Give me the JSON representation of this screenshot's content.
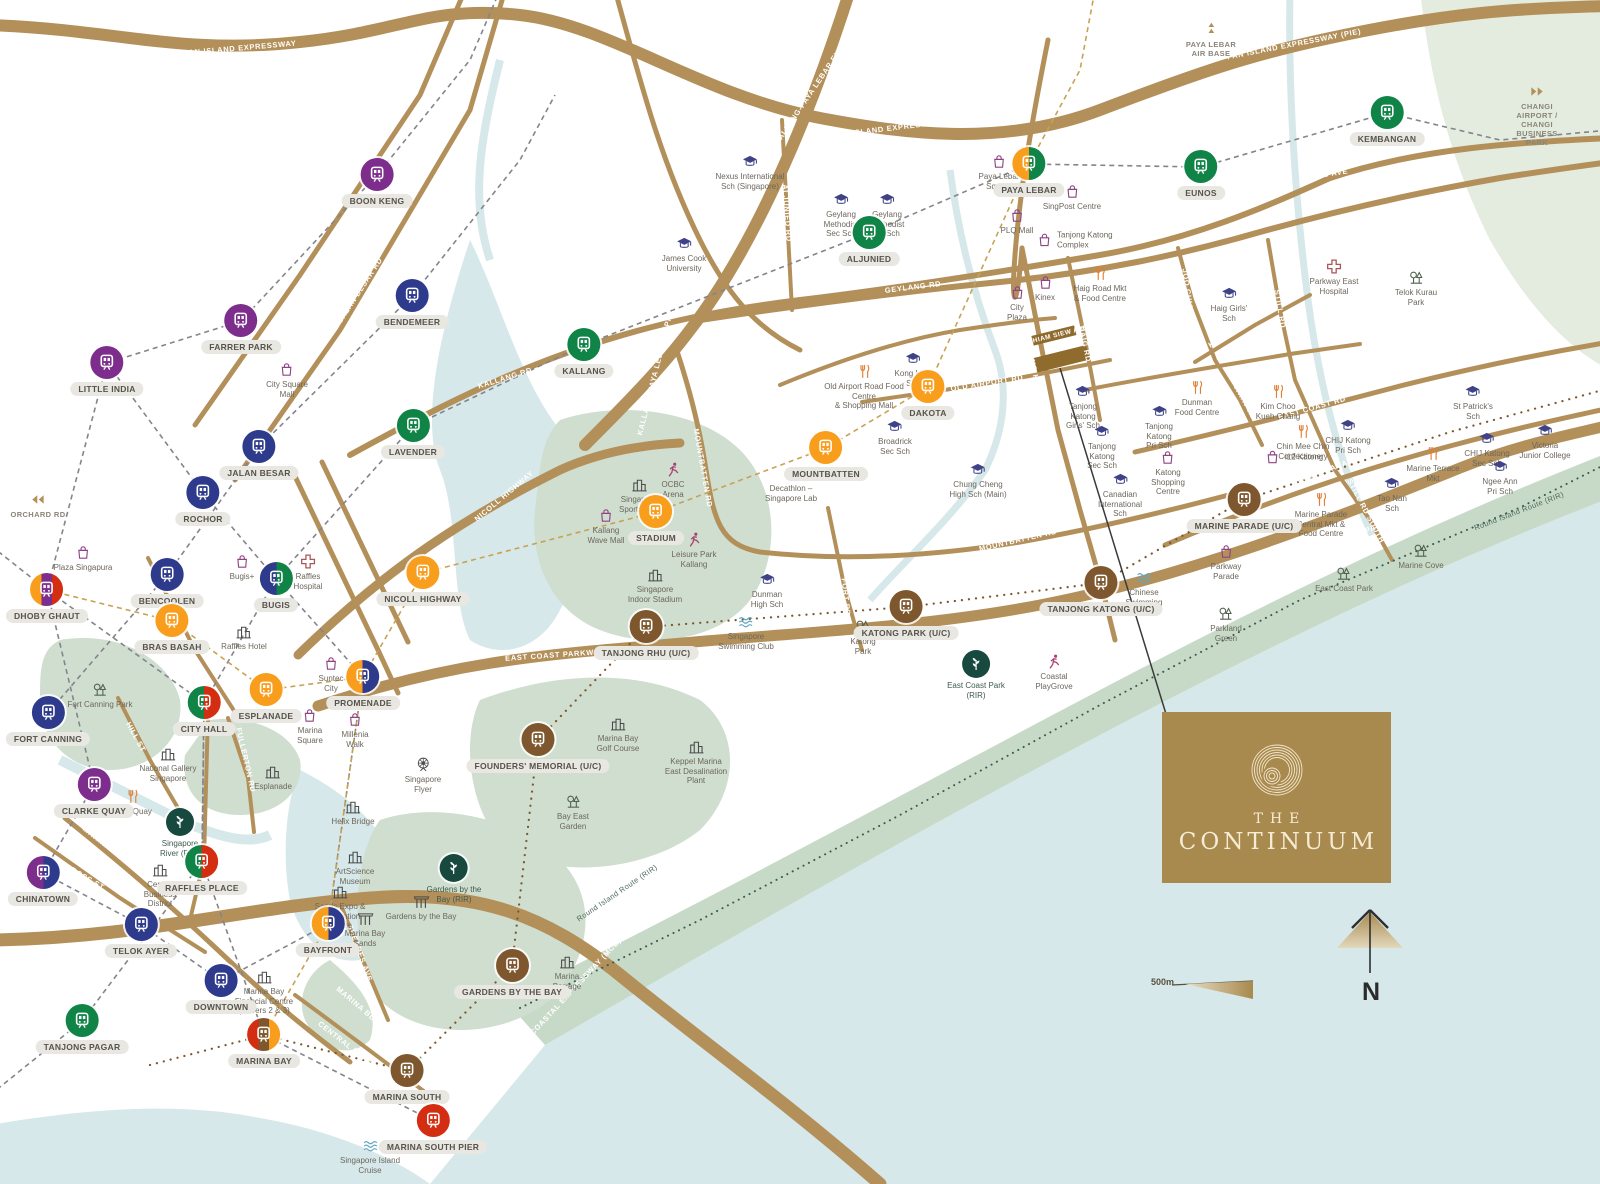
{
  "branding": {
    "line1": "THE",
    "line2": "CONTINUUM"
  },
  "map": {
    "scale": {
      "label": "500m"
    },
    "compass": {
      "label": "N"
    },
    "site": {
      "label": "THIAM SIEW AVE"
    },
    "colors": {
      "ne": "#7d2e8d",
      "dt": "#2e3a8c",
      "ew": "#108347",
      "cc": "#f99d1c",
      "ns": "#d42e12",
      "te": "#7e572e",
      "rir": "#17493f",
      "road": "#b3905a",
      "sea": "#d6e8ea",
      "park": "#cfdecf",
      "brand": "#a8894e"
    },
    "stations": [
      {
        "n": "BOON KENG",
        "x": 377,
        "y": 175,
        "c": [
          "ne"
        ]
      },
      {
        "n": "BENDEMEER",
        "x": 412,
        "y": 296,
        "c": [
          "dt"
        ]
      },
      {
        "n": "FARRER PARK",
        "x": 241,
        "y": 321,
        "c": [
          "ne"
        ]
      },
      {
        "n": "LITTLE INDIA",
        "x": 107,
        "y": 363,
        "c": [
          "ne"
        ]
      },
      {
        "n": "JALAN BESAR",
        "x": 259,
        "y": 447,
        "c": [
          "dt"
        ]
      },
      {
        "n": "ROCHOR",
        "x": 203,
        "y": 493,
        "c": [
          "dt"
        ]
      },
      {
        "n": "LAVENDER",
        "x": 413,
        "y": 426,
        "c": [
          "ew"
        ]
      },
      {
        "n": "KALLANG",
        "x": 584,
        "y": 345,
        "c": [
          "ew"
        ]
      },
      {
        "n": "BENCOOLEN",
        "x": 167,
        "y": 575,
        "c": [
          "dt"
        ]
      },
      {
        "n": "DHOBY GHAUT",
        "x": 47,
        "y": 590,
        "c": [
          "cc",
          "ne",
          "ns"
        ]
      },
      {
        "n": "BUGIS",
        "x": 276,
        "y": 579,
        "c": [
          "dt",
          "ew"
        ]
      },
      {
        "n": "BRAS BASAH",
        "x": 172,
        "y": 621,
        "c": [
          "cc"
        ]
      },
      {
        "n": "NICOLL HIGHWAY",
        "x": 423,
        "y": 573,
        "c": [
          "cc"
        ]
      },
      {
        "n": "ESPLANADE",
        "x": 266,
        "y": 690,
        "c": [
          "cc"
        ]
      },
      {
        "n": "PROMENADE",
        "x": 363,
        "y": 677,
        "c": [
          "cc",
          "dt"
        ]
      },
      {
        "n": "CITY HALL",
        "x": 204,
        "y": 703,
        "c": [
          "ew",
          "ns"
        ]
      },
      {
        "n": "FORT CANNING",
        "x": 48,
        "y": 713,
        "c": [
          "dt"
        ]
      },
      {
        "n": "CLARKE QUAY",
        "x": 94,
        "y": 785,
        "c": [
          "ne"
        ]
      },
      {
        "n": "RAFFLES PLACE",
        "x": 202,
        "y": 862,
        "c": [
          "ew",
          "ns"
        ]
      },
      {
        "n": "CHINATOWN",
        "x": 43,
        "y": 873,
        "c": [
          "ne",
          "dt"
        ]
      },
      {
        "n": "TELOK AYER",
        "x": 141,
        "y": 925,
        "c": [
          "dt"
        ]
      },
      {
        "n": "DOWNTOWN",
        "x": 221,
        "y": 981,
        "c": [
          "dt"
        ]
      },
      {
        "n": "TANJONG PAGAR",
        "x": 82,
        "y": 1021,
        "c": [
          "ew"
        ]
      },
      {
        "n": "MARINA BAY",
        "x": 264,
        "y": 1035,
        "c": [
          "ns",
          "te",
          "cc"
        ]
      },
      {
        "n": "MARINA SOUTH",
        "x": 407,
        "y": 1071,
        "c": [
          "te"
        ]
      },
      {
        "n": "MARINA SOUTH PIER",
        "x": 433,
        "y": 1121,
        "c": [
          "ns"
        ]
      },
      {
        "n": "GARDENS BY THE BAY",
        "x": 512,
        "y": 966,
        "c": [
          "te"
        ]
      },
      {
        "n": "FOUNDERS' MEMORIAL (U/C)",
        "x": 538,
        "y": 740,
        "c": [
          "te"
        ]
      },
      {
        "n": "TANJONG RHU (U/C)",
        "x": 646,
        "y": 627,
        "c": [
          "te"
        ]
      },
      {
        "n": "KATONG PARK (U/C)",
        "x": 906,
        "y": 607,
        "c": [
          "te"
        ]
      },
      {
        "n": "TANJONG KATONG (U/C)",
        "x": 1101,
        "y": 583,
        "c": [
          "te"
        ]
      },
      {
        "n": "MARINE PARADE (U/C)",
        "x": 1244,
        "y": 500,
        "c": [
          "te"
        ]
      },
      {
        "n": "STADIUM",
        "x": 656,
        "y": 512,
        "c": [
          "cc"
        ]
      },
      {
        "n": "MOUNTBATTEN",
        "x": 826,
        "y": 448,
        "c": [
          "cc"
        ]
      },
      {
        "n": "DAKOTA",
        "x": 928,
        "y": 387,
        "c": [
          "cc"
        ]
      },
      {
        "n": "ALJUNIED",
        "x": 869,
        "y": 233,
        "c": [
          "ew"
        ]
      },
      {
        "n": "PAYA LEBAR",
        "x": 1029,
        "y": 164,
        "c": [
          "cc",
          "ew"
        ]
      },
      {
        "n": "EUNOS",
        "x": 1201,
        "y": 167,
        "c": [
          "ew"
        ]
      },
      {
        "n": "KEMBANGAN",
        "x": 1387,
        "y": 113,
        "c": [
          "ew"
        ]
      },
      {
        "n": "BAYFRONT",
        "x": 328,
        "y": 924,
        "c": [
          "cc",
          "dt"
        ]
      }
    ],
    "rir_points": [
      {
        "n": "Singapore\nRiver (RIR)",
        "x": 180,
        "y": 822
      },
      {
        "n": "Gardens by the\nBay (RIR)",
        "x": 454,
        "y": 868
      },
      {
        "n": "East Coast Park\n(RIR)",
        "x": 976,
        "y": 664
      }
    ],
    "landmarks": [
      {
        "n": "City Square\nMall",
        "i": "bag",
        "x": 287,
        "y": 370
      },
      {
        "n": "Plaza Singapura",
        "i": "bag",
        "x": 83,
        "y": 553
      },
      {
        "n": "Bugis+",
        "i": "bag",
        "x": 242,
        "y": 562
      },
      {
        "n": "Suntec\nCity",
        "i": "bag",
        "x": 331,
        "y": 664
      },
      {
        "n": "Marina\nSquare",
        "i": "bag",
        "x": 310,
        "y": 716
      },
      {
        "n": "Millenia\nWalk",
        "i": "bag",
        "x": 355,
        "y": 720
      },
      {
        "n": "Kallang\nWave Mall",
        "i": "bag",
        "x": 606,
        "y": 516
      },
      {
        "n": "Paya Lebar\nSquare",
        "i": "bag",
        "x": 999,
        "y": 162
      },
      {
        "n": "SingPost Centre",
        "i": "bag",
        "x": 1072,
        "y": 192
      },
      {
        "n": "PLQ Mall",
        "i": "bag",
        "x": 1017,
        "y": 216
      },
      {
        "n": "Tanjong Katong\nComplex",
        "i": "bag",
        "x": 1045,
        "y": 240,
        "lp": "r"
      },
      {
        "n": "Kinex",
        "i": "bag",
        "x": 1045,
        "y": 283
      },
      {
        "n": "City\nPlaza",
        "i": "bag",
        "x": 1017,
        "y": 293
      },
      {
        "n": "Katong\nShopping\nCentre",
        "i": "bag",
        "x": 1168,
        "y": 458
      },
      {
        "n": "i12 Katong",
        "i": "bag",
        "x": 1273,
        "y": 457,
        "lp": "r"
      },
      {
        "n": "Parkway\nParade",
        "i": "bag",
        "x": 1226,
        "y": 552
      },
      {
        "n": "Decathlon –\nSingapore Lab",
        "i": "bag",
        "x": 791,
        "y": 474
      },
      {
        "n": "Old Airport Road Food Centre\n& Shopping Mall",
        "i": "food",
        "x": 864,
        "y": 372
      },
      {
        "n": "Haig Road Mkt\n& Food Centre",
        "i": "food",
        "x": 1100,
        "y": 274
      },
      {
        "n": "Dunman\nFood Centre",
        "i": "food",
        "x": 1197,
        "y": 388
      },
      {
        "n": "Kim Choo\nKueh Chang",
        "i": "food",
        "x": 1278,
        "y": 392
      },
      {
        "n": "Chin Mee Chin\nConfectionery",
        "i": "food",
        "x": 1303,
        "y": 432
      },
      {
        "n": "Marine Parade\nCentral Mkt &\nFood Centre",
        "i": "food",
        "x": 1321,
        "y": 500
      },
      {
        "n": "Marine Terrace\nMkt",
        "i": "food",
        "x": 1433,
        "y": 454
      },
      {
        "n": "Boat Quay",
        "i": "food",
        "x": 133,
        "y": 797
      },
      {
        "n": "Nexus International\nSch (Singapore)",
        "i": "school",
        "x": 750,
        "y": 162
      },
      {
        "n": "James Cook\nUniversity",
        "i": "school",
        "x": 684,
        "y": 244
      },
      {
        "n": "Geylang\nMethodist\nSec Sch",
        "i": "school",
        "x": 841,
        "y": 200
      },
      {
        "n": "Geylang\nMethodist\nPri Sch",
        "i": "school",
        "x": 887,
        "y": 200
      },
      {
        "n": "Kong Hwa\nSch",
        "i": "school",
        "x": 913,
        "y": 359
      },
      {
        "n": "Broadrick\nSec Sch",
        "i": "school",
        "x": 895,
        "y": 427
      },
      {
        "n": "Chung Cheng\nHigh Sch (Main)",
        "i": "school",
        "x": 978,
        "y": 470
      },
      {
        "n": "Dunman\nHigh Sch",
        "i": "school",
        "x": 767,
        "y": 580
      },
      {
        "n": "Tanjong\nKatong\nGirls' Sch",
        "i": "school",
        "x": 1083,
        "y": 392
      },
      {
        "n": "Tanjong\nKatong\nSec Sch",
        "i": "school",
        "x": 1102,
        "y": 432
      },
      {
        "n": "Tanjong\nKatong\nPri Sch",
        "i": "school",
        "x": 1159,
        "y": 412
      },
      {
        "n": "Canadian\nInternational\nSch",
        "i": "school",
        "x": 1120,
        "y": 480
      },
      {
        "n": "Haig Girls'\nSch",
        "i": "school",
        "x": 1229,
        "y": 294
      },
      {
        "n": "CHIJ Katong\nPri Sch",
        "i": "school",
        "x": 1348,
        "y": 426
      },
      {
        "n": "CHIJ Katong\nSec Sch",
        "i": "school",
        "x": 1487,
        "y": 439
      },
      {
        "n": "St Patrick's\nSch",
        "i": "school",
        "x": 1473,
        "y": 392
      },
      {
        "n": "Tao Nan\nSch",
        "i": "school",
        "x": 1392,
        "y": 484
      },
      {
        "n": "Ngee Ann\nPri Sch",
        "i": "school",
        "x": 1500,
        "y": 467
      },
      {
        "n": "Victoria\nJunior College",
        "i": "school",
        "x": 1545,
        "y": 431
      },
      {
        "n": "Raffles\nHospital",
        "i": "hospital",
        "x": 308,
        "y": 562
      },
      {
        "n": "Parkway East\nHospital",
        "i": "hospital",
        "x": 1334,
        "y": 267
      },
      {
        "n": "Fort Canning Park",
        "i": "park",
        "x": 100,
        "y": 690
      },
      {
        "n": "Katong\nPark",
        "i": "park",
        "x": 863,
        "y": 627
      },
      {
        "n": "Telok Kurau\nPark",
        "i": "park",
        "x": 1416,
        "y": 278
      },
      {
        "n": "East Coast Park",
        "i": "park",
        "x": 1344,
        "y": 574
      },
      {
        "n": "Parkland\nGreen",
        "i": "park",
        "x": 1226,
        "y": 614
      },
      {
        "n": "Marine Cove",
        "i": "park",
        "x": 1421,
        "y": 551
      },
      {
        "n": "Bay East\nGarden",
        "i": "park",
        "x": 573,
        "y": 802
      },
      {
        "n": "Gardens by the Bay",
        "i": "mbs",
        "x": 421,
        "y": 902
      },
      {
        "n": "Singapore\nSwimming Club",
        "i": "swim",
        "x": 746,
        "y": 622
      },
      {
        "n": "Chinese\nSwimming\nClub",
        "i": "swim",
        "x": 1144,
        "y": 578
      },
      {
        "n": "Singapore Island\nCruise",
        "i": "swim",
        "x": 370,
        "y": 1146
      },
      {
        "n": "OCBC\nArena",
        "i": "run",
        "x": 673,
        "y": 470
      },
      {
        "n": "Leisure Park\nKallang",
        "i": "run",
        "x": 694,
        "y": 540
      },
      {
        "n": "Coastal\nPlayGrove",
        "i": "run",
        "x": 1054,
        "y": 662
      },
      {
        "n": "National Gallery\nSingapore",
        "i": "building",
        "x": 168,
        "y": 754
      },
      {
        "n": "Esplanade",
        "i": "building",
        "x": 273,
        "y": 772
      },
      {
        "n": "Singapore\nFlyer",
        "i": "flyer",
        "x": 423,
        "y": 765
      },
      {
        "n": "Central\nBusiness\nDistrict",
        "i": "building",
        "x": 160,
        "y": 870
      },
      {
        "n": "Marina Bay\nFinancial Centre\n(Towers 2 & 3)",
        "i": "building",
        "x": 264,
        "y": 977
      },
      {
        "n": "ArtScience\nMuseum",
        "i": "building",
        "x": 355,
        "y": 857
      },
      {
        "n": "Sands Expo &\nConvention\nCentre",
        "i": "building",
        "x": 340,
        "y": 892
      },
      {
        "n": "Marina Bay\nSands",
        "i": "mbs",
        "x": 365,
        "y": 919
      },
      {
        "n": "Helix Bridge",
        "i": "building",
        "x": 353,
        "y": 807
      },
      {
        "n": "Singapore\nSports Hub",
        "i": "building",
        "x": 639,
        "y": 485
      },
      {
        "n": "Singapore\nIndoor Stadium",
        "i": "building",
        "x": 655,
        "y": 575
      },
      {
        "n": "Marina Bay\nGolf Course",
        "i": "building",
        "x": 618,
        "y": 724
      },
      {
        "n": "Keppel Marina\nEast Desalination\nPlant",
        "i": "building",
        "x": 696,
        "y": 747
      },
      {
        "n": "Marina\nBarrage",
        "i": "building",
        "x": 567,
        "y": 962
      },
      {
        "n": "Raffles Hotel",
        "i": "building",
        "x": 244,
        "y": 632
      },
      {
        "n": "PAYA LEBAR\nAIR BASE",
        "i": "plane",
        "x": 1211,
        "y": 30,
        "sp": true
      },
      {
        "n": "CHANGI AIRPORT /\nCHANGI BUSINESS PARK",
        "i": "arr-r",
        "x": 1537,
        "y": 92,
        "sp": true
      },
      {
        "n": "ORCHARD RD",
        "i": "arr-l",
        "x": 38,
        "y": 500,
        "sp": true
      }
    ],
    "road_labels": [
      {
        "t": "PAN ISLAND EXPRESSWAY",
        "x": 240,
        "y": 48,
        "r": -5
      },
      {
        "t": "PAN ISLAND EXPRESSWAY (PIE)",
        "x": 900,
        "y": 127,
        "r": -7
      },
      {
        "t": "PAN ISLAND EXPRESSWAY (PIE)",
        "x": 1294,
        "y": 44,
        "r": -11
      },
      {
        "t": "KALLANG-PAYA LEBAR EXPRESSWAY (KPE)",
        "x": 828,
        "y": 67,
        "r": -56
      },
      {
        "t": "KALLANG-PAYA LEBAR EXPRESSWAY (KPE)",
        "x": 662,
        "y": 345,
        "r": -76
      },
      {
        "t": "SERANGOON RD",
        "x": 325,
        "y": 257,
        "r": -57
      },
      {
        "t": "JALAN BESAR RD",
        "x": 360,
        "y": 290,
        "r": -57
      },
      {
        "t": "KALLANG RD",
        "x": 505,
        "y": 378,
        "r": -17
      },
      {
        "t": "NICOLL HIGHWAY",
        "x": 504,
        "y": 496,
        "r": -40
      },
      {
        "t": "OPHIR RD",
        "x": 347,
        "y": 563,
        "r": 64
      },
      {
        "t": "ROCHOR RD",
        "x": 322,
        "y": 592,
        "r": 64
      },
      {
        "t": "SIMS AVE",
        "x": 920,
        "y": 251,
        "r": -7
      },
      {
        "t": "GEYLANG RD",
        "x": 913,
        "y": 287,
        "r": -7
      },
      {
        "t": "GUILLEMARD RD",
        "x": 874,
        "y": 341,
        "r": -9
      },
      {
        "t": "OLD AIRPORT RD",
        "x": 987,
        "y": 383,
        "r": -9
      },
      {
        "t": "ALJUNIED RD",
        "x": 787,
        "y": 213,
        "r": 86
      },
      {
        "t": "CHANGI ROAD",
        "x": 1336,
        "y": 203,
        "r": -8
      },
      {
        "t": "SIMS AVE",
        "x": 1328,
        "y": 174,
        "r": -9
      },
      {
        "t": "DUNMAN RD",
        "x": 1144,
        "y": 373,
        "r": -7
      },
      {
        "t": "EAST COAST RD",
        "x": 1312,
        "y": 408,
        "r": -16
      },
      {
        "t": "JOO CHIAT RD",
        "x": 1189,
        "y": 299,
        "r": 82
      },
      {
        "t": "JOO CHIAT RD",
        "x": 1240,
        "y": 393,
        "r": 61
      },
      {
        "t": "KOON SENG RD",
        "x": 1238,
        "y": 329,
        "r": -30
      },
      {
        "t": "STILL RD",
        "x": 1280,
        "y": 309,
        "r": 80
      },
      {
        "t": "STILL RD SOUTH",
        "x": 1366,
        "y": 511,
        "r": 62
      },
      {
        "t": "MARINE PARADE RD",
        "x": 1332,
        "y": 468,
        "r": -21
      },
      {
        "t": "MOUNTBATTEN RD",
        "x": 703,
        "y": 468,
        "r": 80
      },
      {
        "t": "MOUNTBATTEN RD",
        "x": 1018,
        "y": 540,
        "r": -13
      },
      {
        "t": "FORT RD",
        "x": 846,
        "y": 597,
        "r": 84
      },
      {
        "t": "TANJONG KATONG RD",
        "x": 1036,
        "y": 378,
        "r": 78
      },
      {
        "t": "HAIG RD",
        "x": 1085,
        "y": 344,
        "r": 78
      },
      {
        "t": "EAST COAST PARKWAY (ECP)",
        "x": 568,
        "y": 654,
        "r": -4
      },
      {
        "t": "EAST COAST PARKWAY (ECP)",
        "x": 1012,
        "y": 628,
        "r": -11
      },
      {
        "t": "EAST COAST PARKWAY (ECP)",
        "x": 1370,
        "y": 529,
        "r": -22
      },
      {
        "t": "MARINA COASTAL EXPRESSWAY (MCE)",
        "x": 563,
        "y": 1000,
        "r": -47
      },
      {
        "t": "MARINA BLVD",
        "x": 107,
        "y": 846,
        "r": 38
      },
      {
        "t": "MARINA BLVD",
        "x": 360,
        "y": 1007,
        "r": 40
      },
      {
        "t": "CENTRAL BLVD",
        "x": 345,
        "y": 1043,
        "r": 38
      },
      {
        "t": "SHEARES AVE",
        "x": 360,
        "y": 953,
        "r": 70
      },
      {
        "t": "CROSS ST",
        "x": 85,
        "y": 877,
        "r": 30
      },
      {
        "t": "HILL ST",
        "x": 136,
        "y": 737,
        "r": 61
      },
      {
        "t": "FULLERTON RD",
        "x": 246,
        "y": 760,
        "r": 77
      },
      {
        "t": "SIGLAP PARK CONNECTOR",
        "x": 1446,
        "y": 284,
        "r": 78
      }
    ],
    "route_labels": [
      {
        "t": "Round Island Route (RIR)",
        "x": 617,
        "y": 893,
        "r": -34
      },
      {
        "t": "Round Island Route (RIR)",
        "x": 1519,
        "y": 511,
        "r": -21
      }
    ]
  }
}
